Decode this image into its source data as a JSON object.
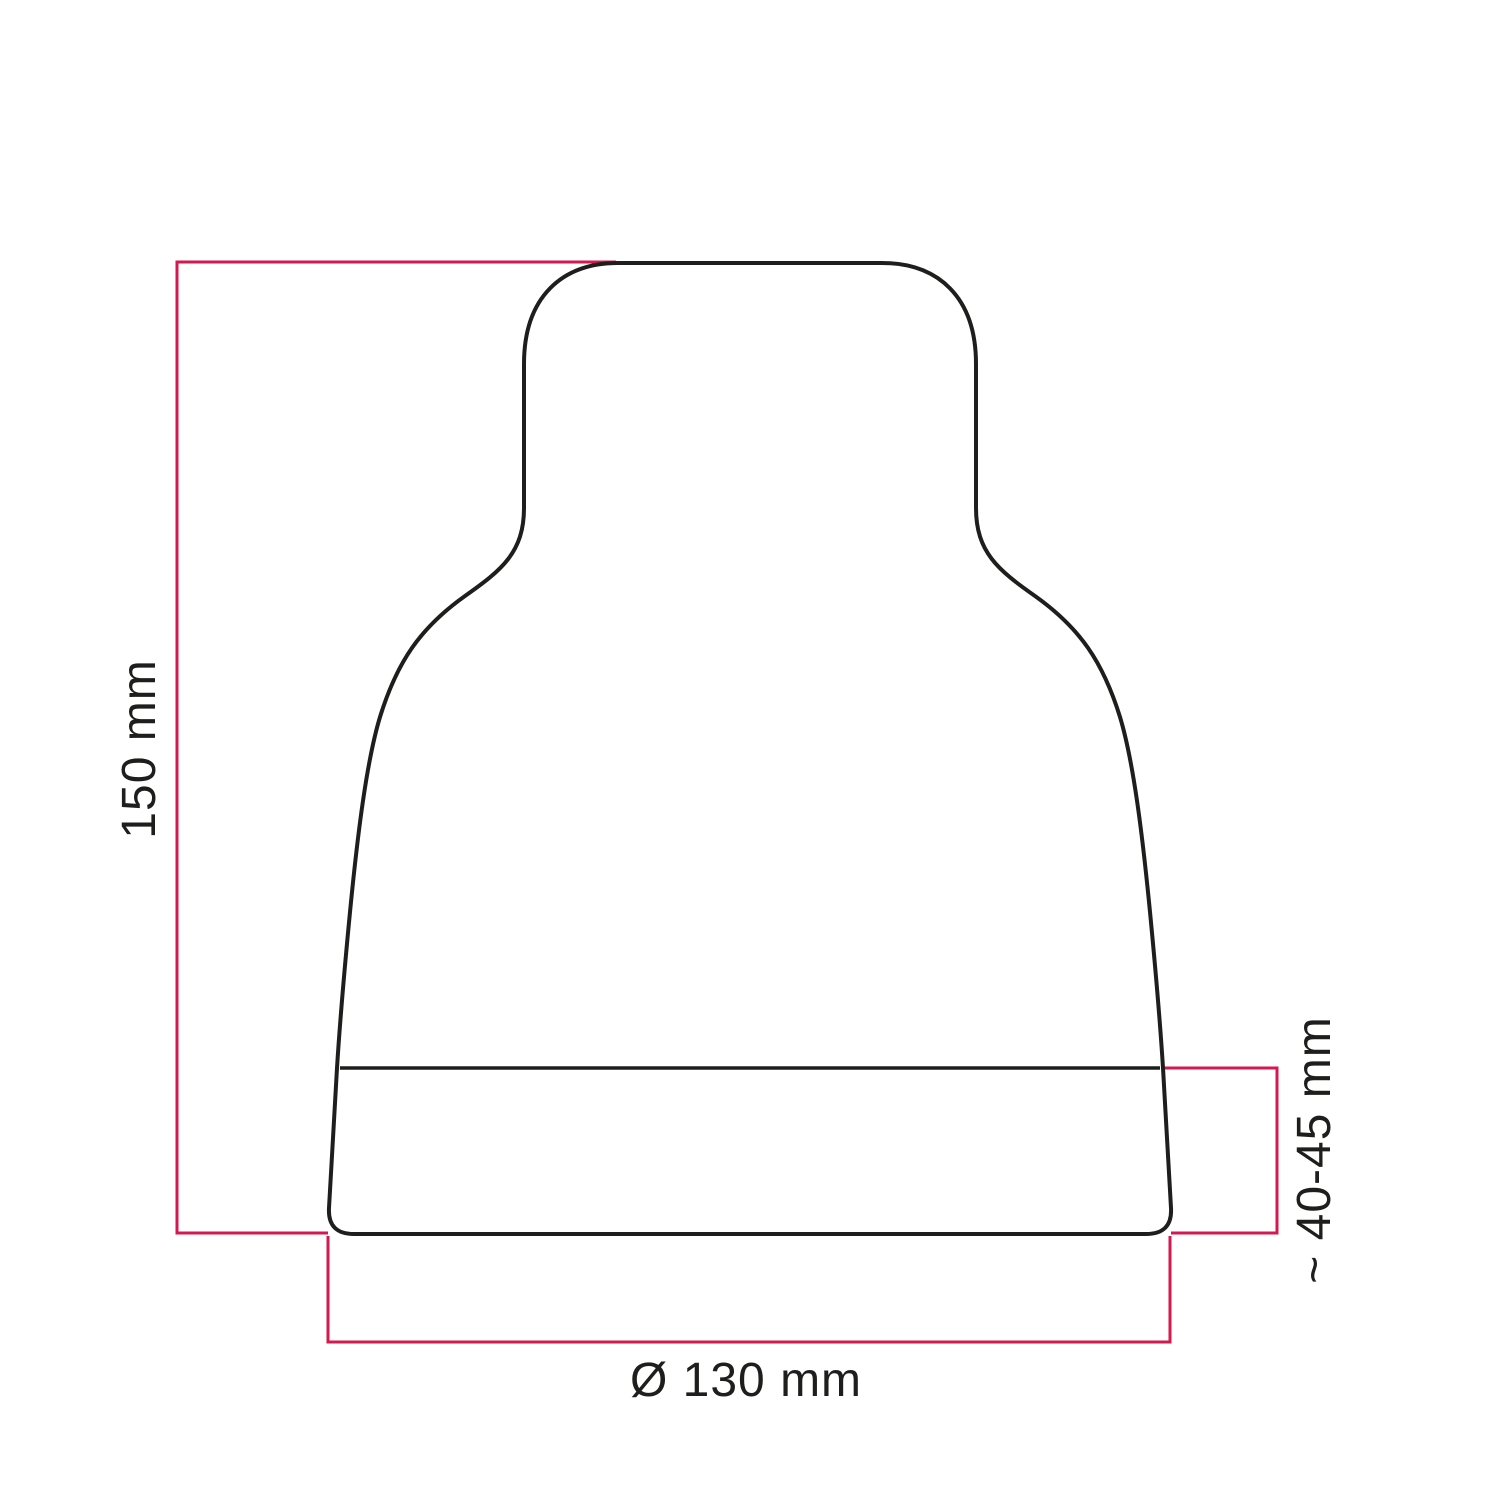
{
  "figure": {
    "type": "technical-dimension-drawing",
    "subject": "vase-shaped lampshade silhouette",
    "background_color": "#ffffff",
    "outline_color": "#1e1e1c",
    "dimension_line_color": "#d4194f",
    "label_color": "#1e1e1c",
    "dimensions": {
      "height": {
        "label": "150 mm",
        "orientation": "vertical-left"
      },
      "base_band_height": {
        "label": "~ 40-45 mm",
        "orientation": "vertical-right"
      },
      "base_diameter": {
        "label": "Ø 130 mm",
        "orientation": "horizontal-bottom"
      }
    }
  }
}
